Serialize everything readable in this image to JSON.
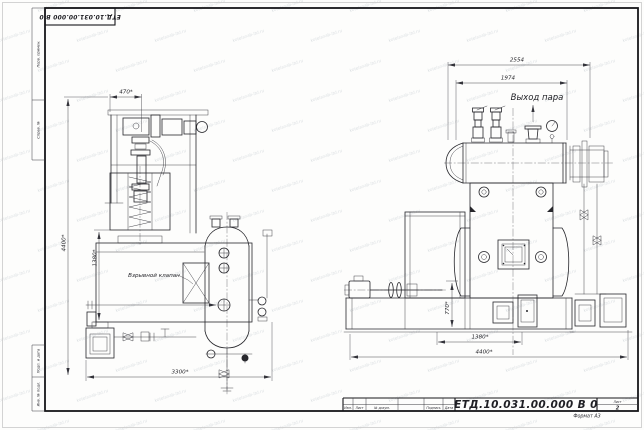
{
  "sheet": {
    "designation": "ЕТД.10.031.00.000  В 0",
    "sheet_label": "Лист",
    "sheet_number": "2",
    "format_note": "Формат А3"
  },
  "title_block": {
    "columns": [
      "Изм.",
      "Лист",
      "№ докум.",
      "Подпись",
      "Дата"
    ]
  },
  "frame": {
    "side_labels": [
      "Перв. примен.",
      "Справ. №",
      "Подп. и дата",
      "Инв. № подл."
    ]
  },
  "annotations": {
    "steam_outlet": "Выход пара",
    "explosion_valve": "Взрывной клапан"
  },
  "dimensions": {
    "left_view": {
      "top_width": "470*",
      "overall_height": "4400*",
      "body_height": "1380*",
      "overall_length": "3300*"
    },
    "right_view": {
      "overall_width": "2554",
      "drum_width": "1974",
      "base_height": "770*",
      "base_inner": "1380*",
      "overall_length": "4400*"
    }
  },
  "watermark": {
    "text": "kotelsnab-ltd.ru"
  },
  "colors": {
    "line": "#26262b",
    "frame": "#16161a",
    "dimension": "#33333a",
    "watermark": "#93a0ab",
    "paper": "#fdfdfc"
  }
}
